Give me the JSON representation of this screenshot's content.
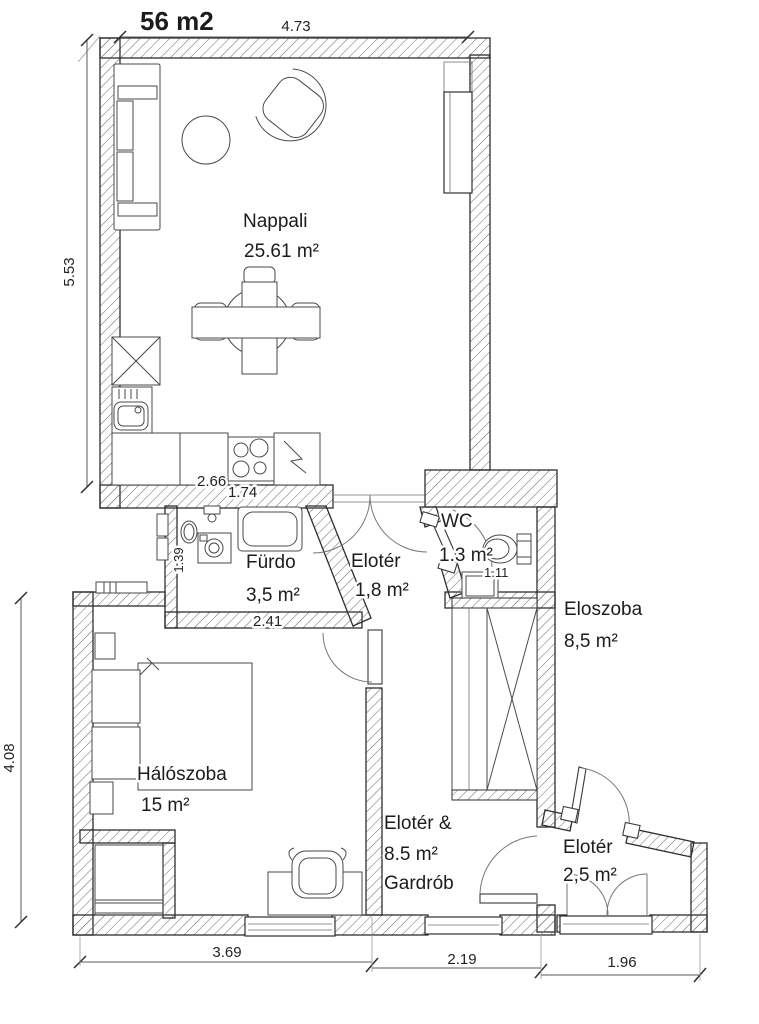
{
  "title": "56 m2",
  "rooms": {
    "nappali": {
      "name": "Nappali",
      "area": "25.61 m²"
    },
    "furdo": {
      "name": "Fürdo",
      "area": "3,5 m²"
    },
    "eloter_small": {
      "name": "Elotér",
      "area": "1,8 m²"
    },
    "wc": {
      "name": "WC",
      "area": "1.3 m²"
    },
    "eloszoba": {
      "name": "Eloszoba",
      "area": "8,5 m²"
    },
    "haloszoba": {
      "name": "Hálószoba",
      "area": "15 m²"
    },
    "eloter_gardrob": {
      "name": "Elotér &",
      "area": "8.5 m²",
      "name2": "Gardrób"
    },
    "eloter_entry": {
      "name": "Elotér",
      "area": "2,5 m²"
    }
  },
  "dimensions": {
    "top": "4.73",
    "left_upper": "5.53",
    "left_lower": "4.08",
    "bottom_left": "3.69",
    "bottom_middle": "2.19",
    "bottom_right": "1.96",
    "kitchen_upper": "2.66",
    "kitchen_lower": "1.74",
    "bath_width": "2.41",
    "bath_height": "1.39",
    "wc_width": "1.11"
  },
  "colors": {
    "wall_line": "#2e2e2e",
    "text": "#1c1c1c",
    "background": "#ffffff"
  }
}
